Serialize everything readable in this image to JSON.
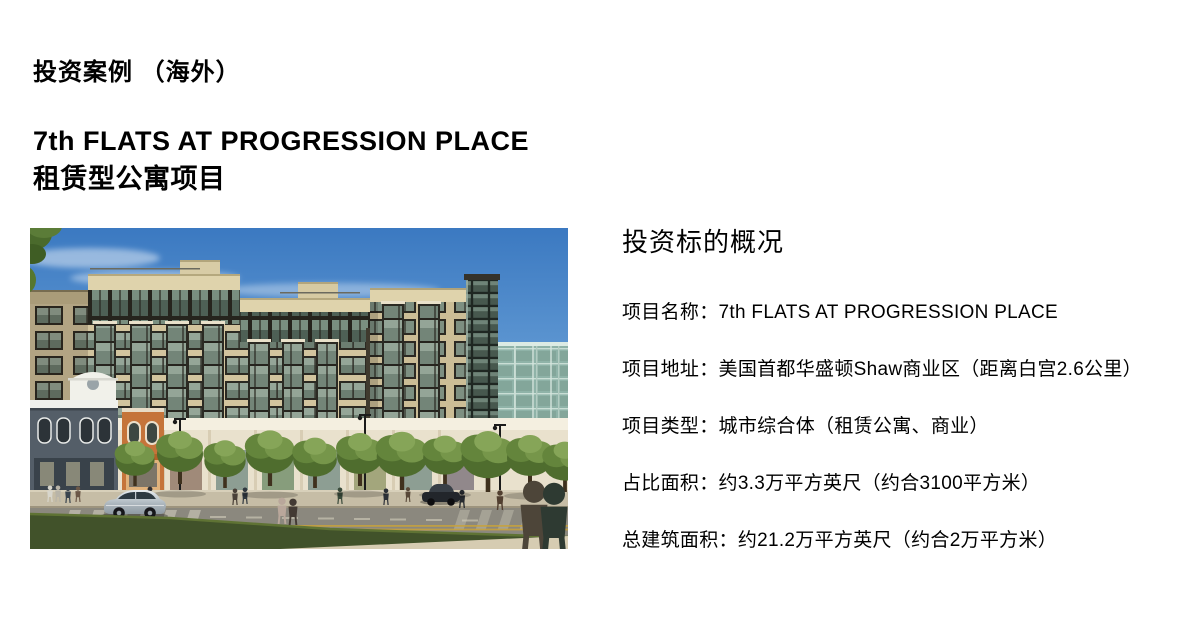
{
  "header": {
    "category": "投资案例 （海外）",
    "title_line1": "7th FLATS AT PROGRESSION PLACE",
    "title_line2": "租赁型公寓项目"
  },
  "overview": {
    "heading": "投资标的概况",
    "items": [
      {
        "label": "项目名称：",
        "value": "7th FLATS AT PROGRESSION PLACE"
      },
      {
        "label": "项目地址：",
        "value": "美国首都华盛顿Shaw商业区（距离白宫2.6公里）"
      },
      {
        "label": "项目类型：",
        "value": "城市综合体（租赁公寓、商业）"
      },
      {
        "label": "占比面积：",
        "value": "约3.3万平方英尺（约合3100平方米）"
      },
      {
        "label": "总建筑面积：",
        "value": "约21.2万平方英尺（约合2万平方米）"
      }
    ]
  },
  "photo": {
    "subject": "building-rendering"
  },
  "colors": {
    "text": "#000000",
    "background": "#ffffff",
    "sky": "#3b79c1",
    "facade": "#d2c49e",
    "grass": "#41522a"
  }
}
